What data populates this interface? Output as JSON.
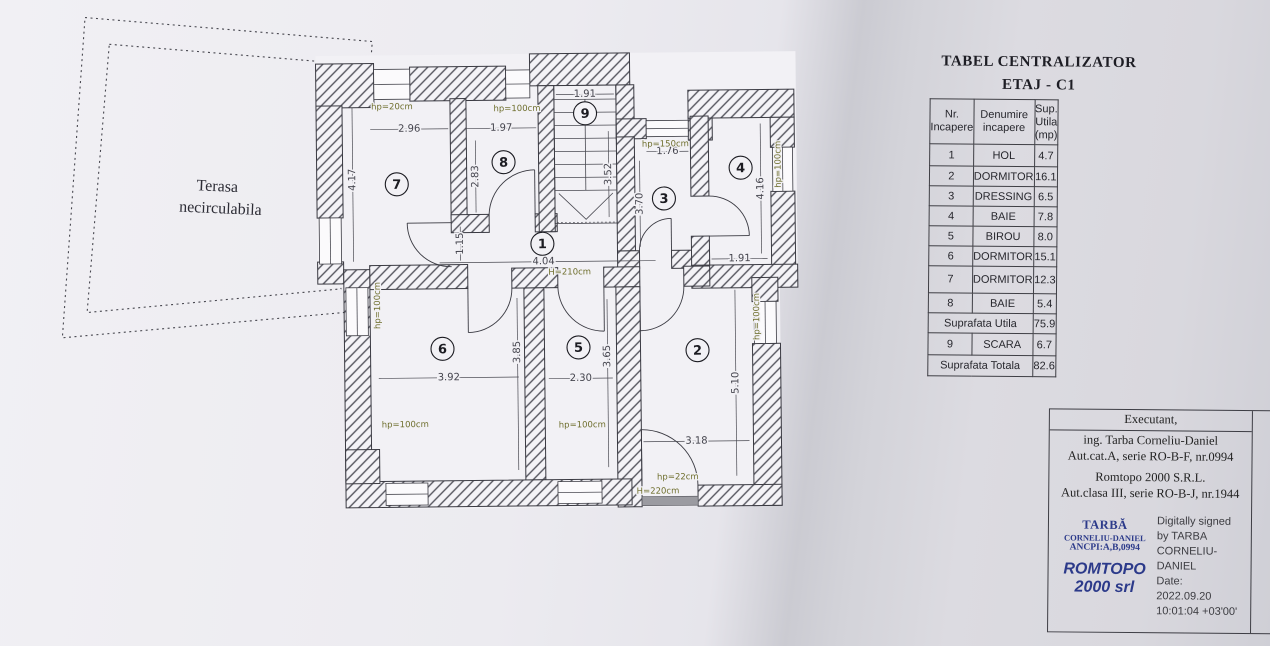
{
  "plan": {
    "terrace": {
      "line1": "Terasa",
      "line2": "necirculabila"
    },
    "rooms": {
      "r1": "1",
      "r2": "2",
      "r3": "3",
      "r4": "4",
      "r5": "5",
      "r6": "6",
      "r7": "7",
      "r8": "8",
      "r9": "9"
    },
    "dims": {
      "room7_w": "2.96",
      "room8_w": "1.97",
      "room8_h": "2.83",
      "left_wall": "4.17",
      "stairs_w": "1.91",
      "stairs_h": "3.52",
      "room3_w": "1.76",
      "room3_h": "3.70",
      "room4_h": "4.16",
      "room4_w": "1.91",
      "hall_h": "1.15",
      "hall_w": "4.04",
      "room6_w": "3.92",
      "room6_h": "3.85",
      "room5_w": "2.30",
      "room5_h": "3.65",
      "room2_w": "3.18",
      "room2_h": "5.10"
    },
    "hp": {
      "r7_top": "hp=20cm",
      "r8_top": "hp=100cm",
      "r3_top": "hp=150cm",
      "r4_right": "hp=100cm",
      "r6_left": "hp=100cm",
      "r6_bottom": "hp=100cm",
      "r5_bottom": "hp=100cm",
      "r2_right": "hp=100cm",
      "balcony": "hp=22cm",
      "balcony_door": "H=220cm",
      "hall_door": "H=210cm"
    },
    "colors": {
      "wall_line": "#3a3a42",
      "hp_text": "#6f6f2e",
      "dim_text": "#45454e",
      "sill": "#9b9ba1"
    }
  },
  "table": {
    "title_line1": "TABEL CENTRALIZATOR",
    "title_line2": "ETAJ - C1",
    "headers": {
      "col1": "Nr.\nIncapere",
      "col2": "Denumire\nincapere",
      "col3": "Sup.\nUtila\n(mp)"
    },
    "rows": [
      [
        "1",
        "HOL",
        "4.7"
      ],
      [
        "2",
        "DORMITOR",
        "16.1"
      ],
      [
        "3",
        "DRESSING",
        "6.5"
      ],
      [
        "4",
        "BAIE",
        "7.8"
      ],
      [
        "5",
        "BIROU",
        "8.0"
      ],
      [
        "6",
        "DORMITOR",
        "15.1"
      ],
      [
        "7",
        "DORMITOR",
        "12.3"
      ],
      [
        "8",
        "BAIE",
        "5.4"
      ]
    ],
    "suprafata_utila": {
      "label": "Suprafata Utila",
      "value": "75.9"
    },
    "scara_row": {
      "nr": "9",
      "name": "SCARA",
      "value": "6.7"
    },
    "suprafata_totala": {
      "label": "Suprafata Totala",
      "value": "82.6"
    }
  },
  "executant": {
    "header": "Executant,",
    "line1": "ing. Tarba Corneliu-Daniel",
    "line2": "Aut.cat.A, serie RO-B-F, nr.0994",
    "line3": "Romtopo 2000 S.R.L.",
    "line4": "Aut.clasa III, serie RO-B-J, nr.1944",
    "stamp": {
      "name": "TARBĂ",
      "name2": "CORNELIU-DANIEL",
      "ancpi": "ANCPI:A,B,0994",
      "firm1": "ROMTOPO",
      "firm2": "2000 srl",
      "color": "#2c3a8a"
    },
    "signature": {
      "l1": "Digitally signed",
      "l2": "by TARBA",
      "l3": "CORNELIU-",
      "l4": "DANIEL",
      "l5": "Date:",
      "l6": "2022.09.20",
      "l7": "10:01:04 +03'00'"
    }
  }
}
